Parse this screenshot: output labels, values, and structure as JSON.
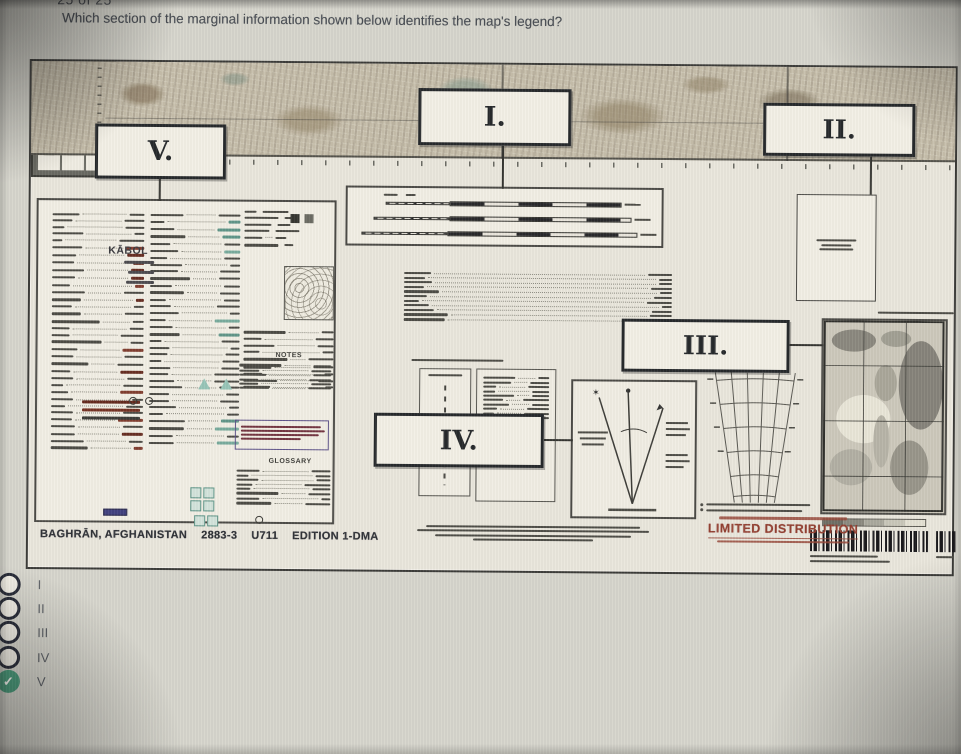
{
  "header": {
    "progress": "25 of 25",
    "question": "Which section of the marginal information shown below identifies the map's legend?"
  },
  "exhibit": {
    "section_labels": {
      "i": "I.",
      "ii": "II.",
      "iii": "III.",
      "iv": "IV.",
      "v": "V."
    },
    "legend_panel": {
      "place_name": "KĀBOL",
      "notes_heading": "NOTES",
      "glossary_heading": "GLOSSARY"
    },
    "sheet_info": {
      "name": "BAGHRĀN, AFGHANISTAN",
      "sheet": "2883-3",
      "series": "U711",
      "edition": "EDITION 1-DMA"
    },
    "distribution_notice": "LIMITED DISTRIBUTION"
  },
  "options": [
    {
      "label": "I",
      "selected": false
    },
    {
      "label": "II",
      "selected": false
    },
    {
      "label": "III",
      "selected": false
    },
    {
      "label": "IV",
      "selected": false
    },
    {
      "label": "V",
      "selected": true
    }
  ],
  "colors": {
    "selected_green": "#3ea17c",
    "distribution_red": "#9e3c2d"
  }
}
